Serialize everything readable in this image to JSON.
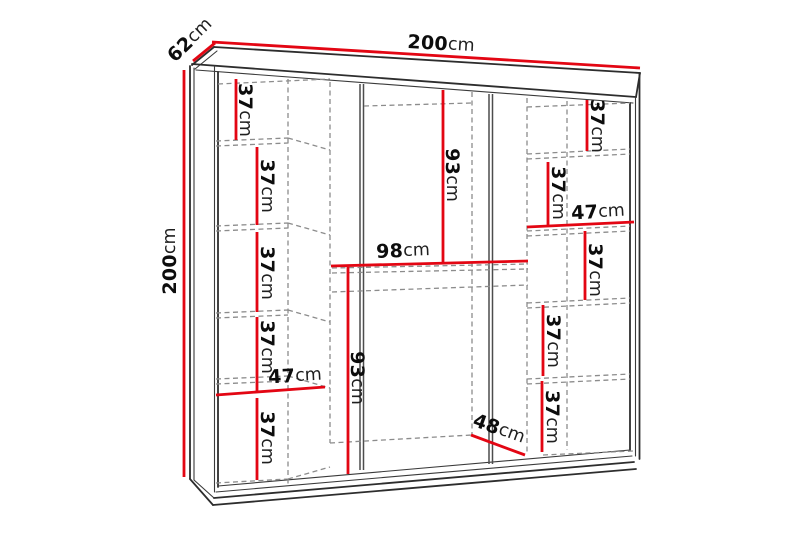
{
  "diagram": {
    "background_color": "#ffffff",
    "dimension_line_color": "#e30613",
    "outline_color": "#2d2d2d",
    "hidden_line_color": "#8c8c8c",
    "overall": {
      "width": {
        "value": "200",
        "unit": "cm"
      },
      "depth": {
        "value": "62",
        "unit": "cm"
      },
      "height": {
        "value": "200",
        "unit": "cm"
      }
    },
    "left_column": {
      "width": {
        "value": "47",
        "unit": "cm"
      },
      "shelf_spacings": [
        {
          "value": "37",
          "unit": "cm"
        },
        {
          "value": "37",
          "unit": "cm"
        },
        {
          "value": "37",
          "unit": "cm"
        },
        {
          "value": "37",
          "unit": "cm"
        },
        {
          "value": "37",
          "unit": "cm"
        }
      ]
    },
    "middle_section": {
      "upper_height": {
        "value": "93",
        "unit": "cm"
      },
      "shelf_width": {
        "value": "98",
        "unit": "cm"
      },
      "lower_height": {
        "value": "93",
        "unit": "cm"
      },
      "bottom_depth": {
        "value": "48",
        "unit": "cm"
      }
    },
    "right_column": {
      "width": {
        "value": "47",
        "unit": "cm"
      },
      "shelf_spacings": [
        {
          "value": "37",
          "unit": "cm"
        },
        {
          "value": "37",
          "unit": "cm"
        },
        {
          "value": "37",
          "unit": "cm"
        },
        {
          "value": "37",
          "unit": "cm"
        },
        {
          "value": "37",
          "unit": "cm"
        }
      ]
    }
  }
}
